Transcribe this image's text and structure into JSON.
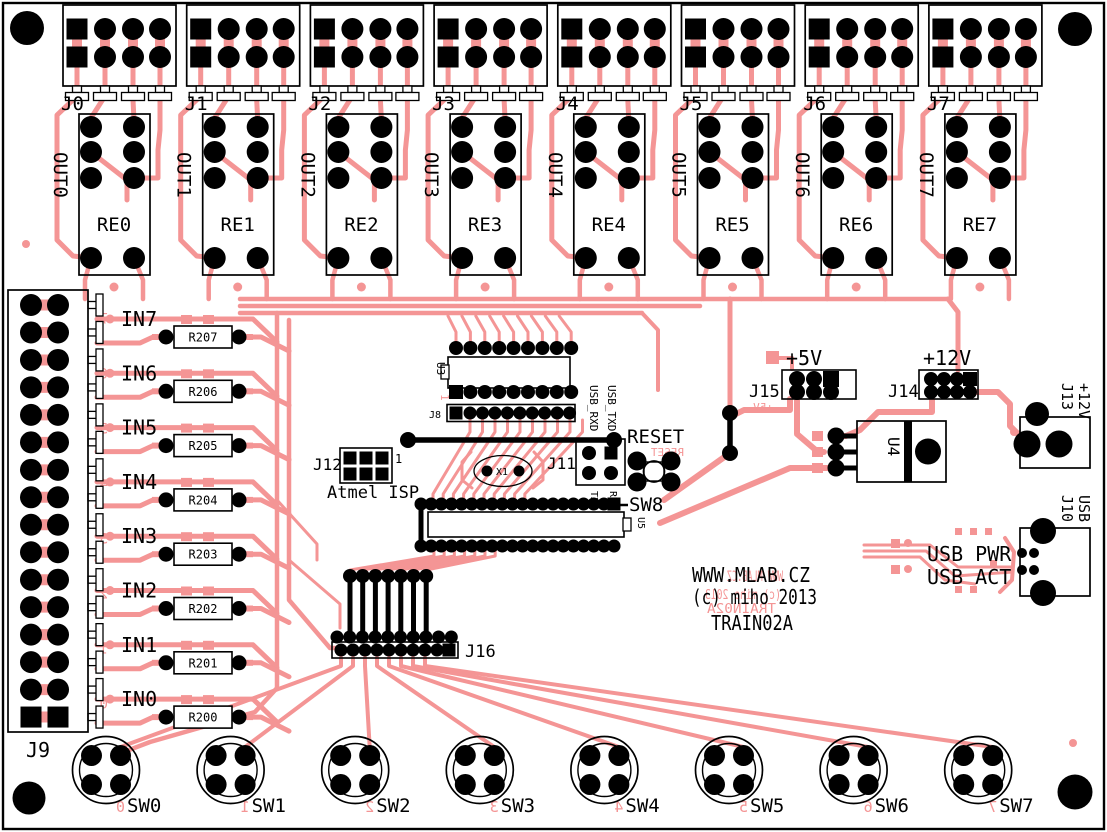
{
  "colors": {
    "copper": "#F49595",
    "silk": "#000000",
    "board": "#FFFFFF"
  },
  "center_text": {
    "line1": "WWW.MLAB.CZ",
    "line2": "(c) miho 2013",
    "line3": "TRAIN02A"
  },
  "left_connector": "J9",
  "relay_blocks": [
    {
      "connector": "J0",
      "relay": "RE0",
      "out": "OUT0"
    },
    {
      "connector": "J1",
      "relay": "RE1",
      "out": "OUT1"
    },
    {
      "connector": "J2",
      "relay": "RE2",
      "out": "OUT2"
    },
    {
      "connector": "J3",
      "relay": "RE3",
      "out": "OUT3"
    },
    {
      "connector": "J4",
      "relay": "RE4",
      "out": "OUT4"
    },
    {
      "connector": "J5",
      "relay": "RE5",
      "out": "OUT5"
    },
    {
      "connector": "J6",
      "relay": "RE6",
      "out": "OUT6"
    },
    {
      "connector": "J7",
      "relay": "RE7",
      "out": "OUT7"
    }
  ],
  "inputs": [
    {
      "label": "IN7",
      "resistor": "R207",
      "pin": "7"
    },
    {
      "label": "IN6",
      "resistor": "R206",
      "pin": "6"
    },
    {
      "label": "IN5",
      "resistor": "R205",
      "pin": "5"
    },
    {
      "label": "IN4",
      "resistor": "R204",
      "pin": "4"
    },
    {
      "label": "IN3",
      "resistor": "R203",
      "pin": "3"
    },
    {
      "label": "IN2",
      "resistor": "R202",
      "pin": "2"
    },
    {
      "label": "IN1",
      "resistor": "R201",
      "pin": "1"
    },
    {
      "label": "IN0",
      "resistor": "R200",
      "pin": "0"
    }
  ],
  "switches": [
    {
      "label": "SW0",
      "pin": "0"
    },
    {
      "label": "SW1",
      "pin": "1"
    },
    {
      "label": "SW2",
      "pin": "2"
    },
    {
      "label": "SW3",
      "pin": "3"
    },
    {
      "label": "SW4",
      "pin": "4"
    },
    {
      "label": "SW5",
      "pin": "5"
    },
    {
      "label": "SW6",
      "pin": "6"
    },
    {
      "label": "SW7",
      "pin": "7"
    }
  ],
  "mcu": {
    "u3": "U3",
    "pin1": "1",
    "j8": "J8",
    "usb_rxd": "USB_RXD",
    "usb_txd": "USB_TXD",
    "j12": "J12",
    "j12_pin1": "1",
    "isp_label": "Atmel ISP",
    "x1": "X1",
    "j11": "J11",
    "txd": "TXD",
    "rxd": "RXD",
    "reset": "RESET",
    "sw8": "SW8",
    "u5": "U5",
    "j16": "J16"
  },
  "power": {
    "plus5v": "+5V",
    "j15": "J15",
    "plus12v": "+12V",
    "j14": "J14",
    "u4": "U4",
    "j13": "J13",
    "j13_voltage": "+12V",
    "j10": "J10",
    "j10_type": "USB",
    "usb_pwr": "USB PWR",
    "usb_act": "USB ACT"
  }
}
